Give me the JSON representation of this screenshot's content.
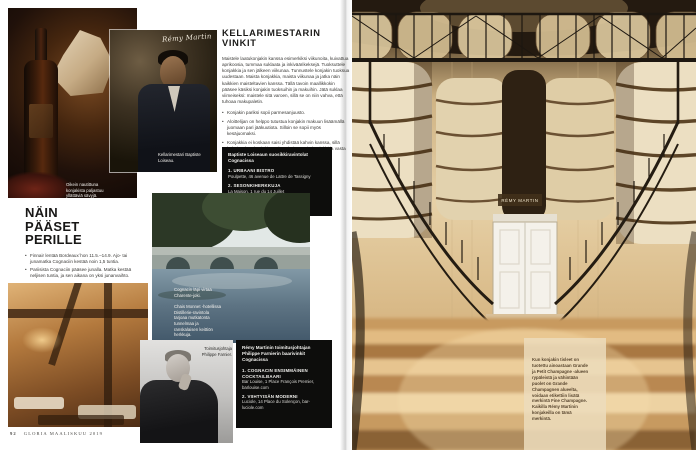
{
  "page": {
    "number": "92",
    "footer": "GLORIA MAALISKUU 2019"
  },
  "tips": {
    "heading": "KELLARIMESTARIN VINKIT",
    "intro": "Maistele laatukonjakin kanssa esimerkiksi viikunoita, kuivattua aprikoosia, tummaa suklaata ja inkiväärikeksejä. Tuoksuttele konjakkia ja sen jälkeen viikunaa. Tunnustele konjakin tuoksua uudestaan. Maista konjakkia, maista viikunaa ja jatka näin kaikkien maisteltavien kanssa. Tällä tavoin maallikkokin pääsee käsiksi konjakin tuoksuihin ja makuihin. Jätä suklaa viimeiseksi: maistele sitä varoen, sillä se on niin vahva, että tuhoaa makupaletin.",
    "bullets": [
      "Konjakin pariksi sopii parmesanjuusto.",
      "Aloittelijan on helppo tutustua konjakin makuun lisäämällä juomaan pari jääkuutiota. Silloin se sopii myös kesäjuomaksi.",
      "Konjakkia ei koskaan saisi yhdistää kahvin kanssa, sillä kahvi sotkee konjakin makupaletin. Ensin konjakki ja vasta pienen tauon jälkeen kahvi."
    ]
  },
  "restaurants": {
    "heading": "Baptiste Loiseaun suosikkiravintolat Cognacissa",
    "items": [
      {
        "label": "1. URBAANI BISTRO",
        "detail": "Poulpette, 46 avenue de Lattre de Tassigny"
      },
      {
        "label": "2. SESONKIHERKKUJA",
        "detail": "La Maison, 1 rue du 14 Juillet"
      },
      {
        "label": "3. PERINTEINEN BRASSERIE",
        "detail": "Le Coq d'Or, 33 Place François 1er"
      }
    ]
  },
  "directions": {
    "heading": "NÄIN PÄÄSET PERILLE",
    "bullets": [
      "Finnair lentää Bordeaux´hon 11.5.–14.9. Ajo- tai junamatka Cognaciin kestää noin 1,5 tuntia.",
      "Pariisista Cognaciin pääsee junalla. Matka kestää neljisen tuntia, ja sen aikana on yksi junanvaihto."
    ]
  },
  "bars": {
    "heading": "Rémy Martinin toimitusjohtajan Philippe Farnierin baarivinkit Cognacissa",
    "items": [
      {
        "label": "1. COGNACIN ENSIMMÄINEN COCKTAILBAARI",
        "detail": "Bar Louise, 1 Place François Premier, barlouise.com"
      },
      {
        "label": "2. VIIHTYISÄN MODERNI",
        "detail": "Luciole, 14 Place du Solençon, bar-luciole.com"
      }
    ]
  },
  "captions": {
    "bottle": "Oikein nautittuna konjakista paljastuu yllättäviä sävyjä.",
    "cellar_master": "Kellarimestari Baptiste Loiseau.",
    "river": "Cognacin läpi virtaa Charente-joki.",
    "hotel": "Chais Monnet -hotellissa Distillerie-ravintola tarjoaa mutkatonta tunnelmaa ja ranskalaisen keittiön herkkuja.",
    "ceo": "Toimitusjohtaja Philippe Farnier.",
    "fine_champagne": "Kun konjakin tisleet on tuotettu ainoastaan Grande ja Petit Champagne -alueen rypäleistä ja vähintään puolet on Grande Champagnen alueelta, voidaan etikettiin lisätä merkintä Fine Champagne. Kaikilla Rémy Martinin konjakeilla on tämä merkintä."
  },
  "brand": {
    "signature": "Rémy Martin",
    "barrel_label": "RÉMY MARTIN"
  },
  "colors": {
    "box_black": "#0d0d0c",
    "text_dark": "#3a3936",
    "cellar_cream": "#e8d8b4",
    "cellar_wood": "#c79a60"
  }
}
